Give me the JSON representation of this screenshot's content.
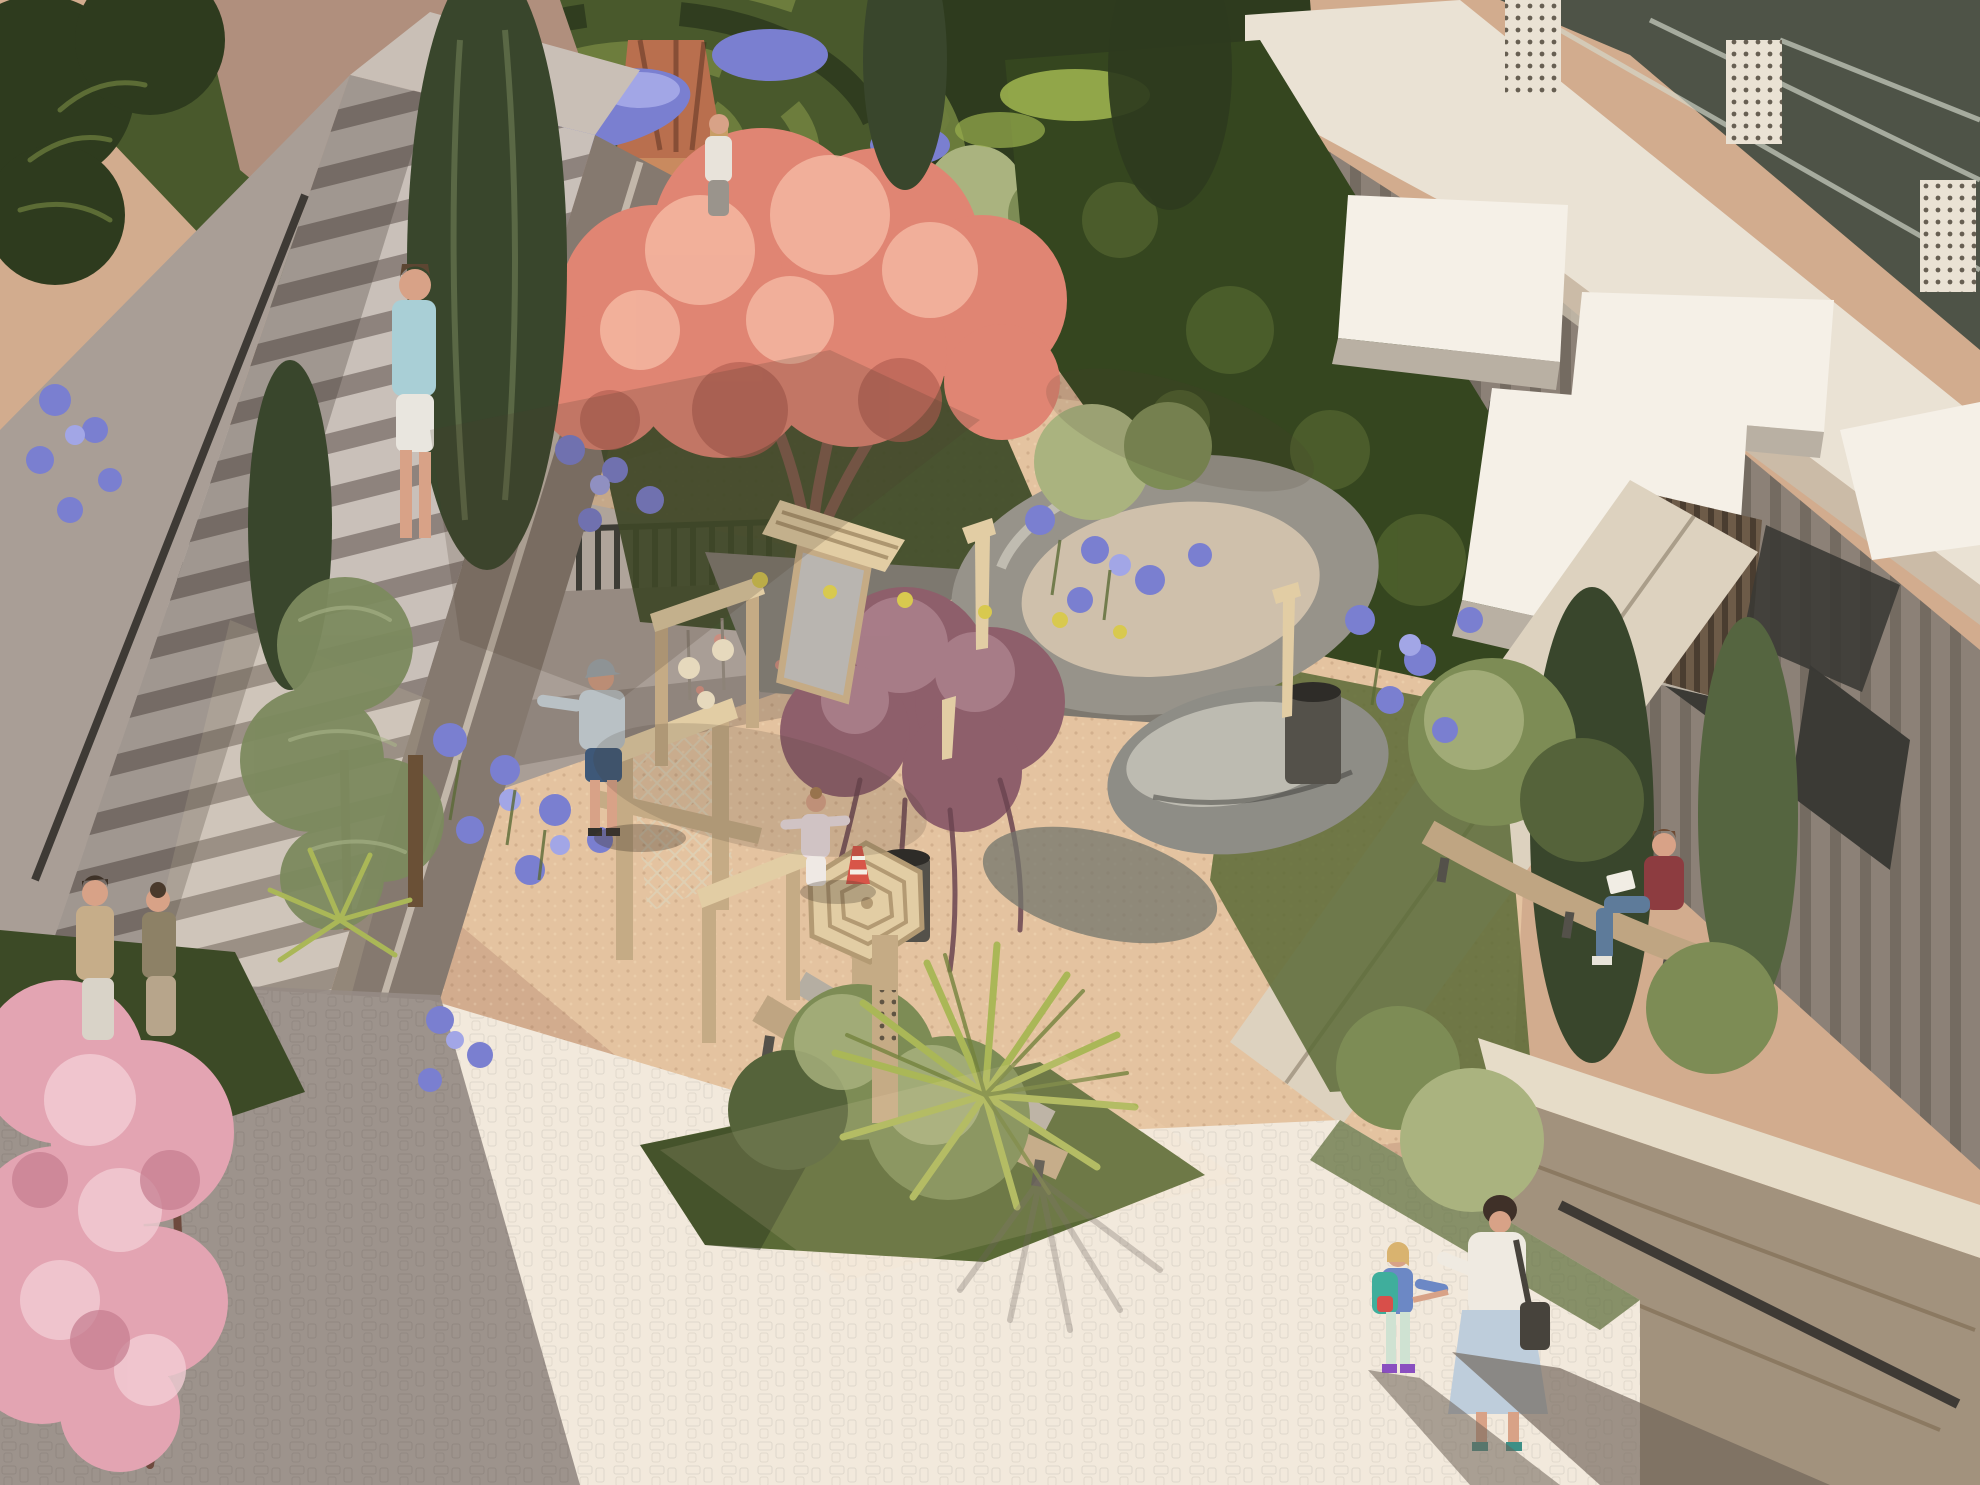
{
  "scene": {
    "type": "architectural-rendering",
    "subject": "sunlit residential courtyard garden with hedge maze, play area, staircases and curved apartment building",
    "view": "aerial three-quarter view",
    "lighting": "strong sun from upper left, long diagonal shadows"
  },
  "palette": {
    "gravel_base": "#d2ac8e",
    "gravel_light": "#e9cba6",
    "gravel_shadow": "#9b7f6a",
    "cobble_sun": "#f2e9dc",
    "cobble_shade": "#968b84",
    "cobble_deep": "#6f6660",
    "concrete_light": "#c9bfb6",
    "concrete_mid": "#a99e96",
    "concrete_dark": "#85796f",
    "step_tread": "#c9c0b9",
    "step_shadow": "#8e837d",
    "wall_tan": "#b08f7d",
    "wall_tan_dark": "#8d6f60",
    "planter_gray": "#7d786f",
    "hedge_dark": "#2e3b1e",
    "hedge_mid": "#49592c",
    "hedge_light": "#71823f",
    "topiary_light": "#aab37f",
    "topiary_mid": "#7d8c55",
    "topiary_dark": "#55633a",
    "cypress_dark": "#39462c",
    "cypress_mid": "#556540",
    "cypress_light": "#7c8a5e",
    "ivy_dark": "#35461f",
    "ivy_light": "#5c7034",
    "ivy_lime": "#9bb04e",
    "coral_main": "#e08573",
    "coral_light": "#f4b7a1",
    "coral_dark": "#b55f53",
    "maple_main": "#8e5f6b",
    "maple_light": "#b08691",
    "maple_dark": "#6b4551",
    "cherry_main": "#e3a4b2",
    "cherry_light": "#f3cdd4",
    "cherry_dark": "#c47c8f",
    "agapanthus_main": "#7a7fd0",
    "agapanthus_light": "#a2a6e6",
    "palm_light": "#aab757",
    "palm_dark": "#74833d",
    "grass_dark": "#3c4a26",
    "grass_mid": "#5a6a36",
    "sand_fill": "#cfc0ab",
    "sand_ring": "#97938a",
    "rock_gray": "#8e8d86",
    "rock_light": "#c6c3b8",
    "pebble_dark": "#73766c",
    "wood_light": "#e2cda4",
    "wood_mid": "#c5ab85",
    "wood_dark": "#8e7354",
    "bench_wood": "#bfa582",
    "bench_stone": "#b5aea2",
    "bin_dark": "#54514a",
    "cream_band": "#eae2d4",
    "cream_shadow": "#c9bfae",
    "stone_col": "#8c8177",
    "window_dark": "#3b3a35",
    "awning_white": "#f5f0e7",
    "awning_shade": "#b9b0a3",
    "glass_dark": "#4e5347",
    "glass_streak": "#d6dacd",
    "slat_brown": "#6d5b48",
    "travertine": "#ddd2bf",
    "wall_stone_face": "#a2927d",
    "wall_stone_top": "#e6dcc8",
    "rail_dark": "#3e3a35",
    "skin": "#d8a287",
    "trunk_brown": "#7d5a4a",
    "branch_dark": "#6e4a3e",
    "shadow_warm": "#4a3a2d",
    "sun_glow": "#ffe9c6",
    "yellow_flower": "#d8c94f",
    "cone_red": "#d85548",
    "fence_dark": "#3a3d38",
    "sculpture_terracotta": "#b96f4e",
    "sculpture_base": "#c98a5f"
  },
  "people": [
    {
      "id": "walker-top-left",
      "shirt": "#a9cfd6",
      "shorts": "#e9e6df",
      "hair": "#5c4632"
    },
    {
      "id": "woman-by-maze",
      "top": "#e8e3da",
      "pants": "#9a948c",
      "hair": "#c89e66"
    },
    {
      "id": "boy-with-cap",
      "cap": "#9fa9b0",
      "shirt": "#b9c1c5",
      "shorts": "#3e5878",
      "hair": "#6b4f35"
    },
    {
      "id": "girl-playing",
      "top": "#ecdfe2",
      "pants": "#efe9e4",
      "hair": "#a97f54"
    },
    {
      "id": "man-bottom-left",
      "shirt": "#c6ad89",
      "pants": "#d9d3c8",
      "hair": "#3e3228"
    },
    {
      "id": "woman-bottom-left",
      "top": "#8d8166",
      "skirt": "#b7a58b",
      "hair": "#4a3a2c"
    },
    {
      "id": "person-reading-bench",
      "shirt": "#8d3c40",
      "jeans": "#5e7b9a",
      "hair": "#6e4a33",
      "paper": "#f1ede4"
    },
    {
      "id": "mother-walking",
      "blouse": "#efeae1",
      "skirt": "#becddb",
      "bag": "#47433c",
      "hair": "#3f3028",
      "shoes": "#3e8f86"
    },
    {
      "id": "child-with-backpack",
      "top": "#6c88c5",
      "backpack": "#3fae9c",
      "backpack_pocket": "#d84f4a",
      "leggings": "#cfe2d2",
      "shoes": "#8a4fc0",
      "hair": "#d9b36f"
    }
  ],
  "counts": {
    "people_visible": 9,
    "awnings": 4,
    "curved_benches": 2,
    "staircases": 2,
    "topiary_balls": 12
  }
}
